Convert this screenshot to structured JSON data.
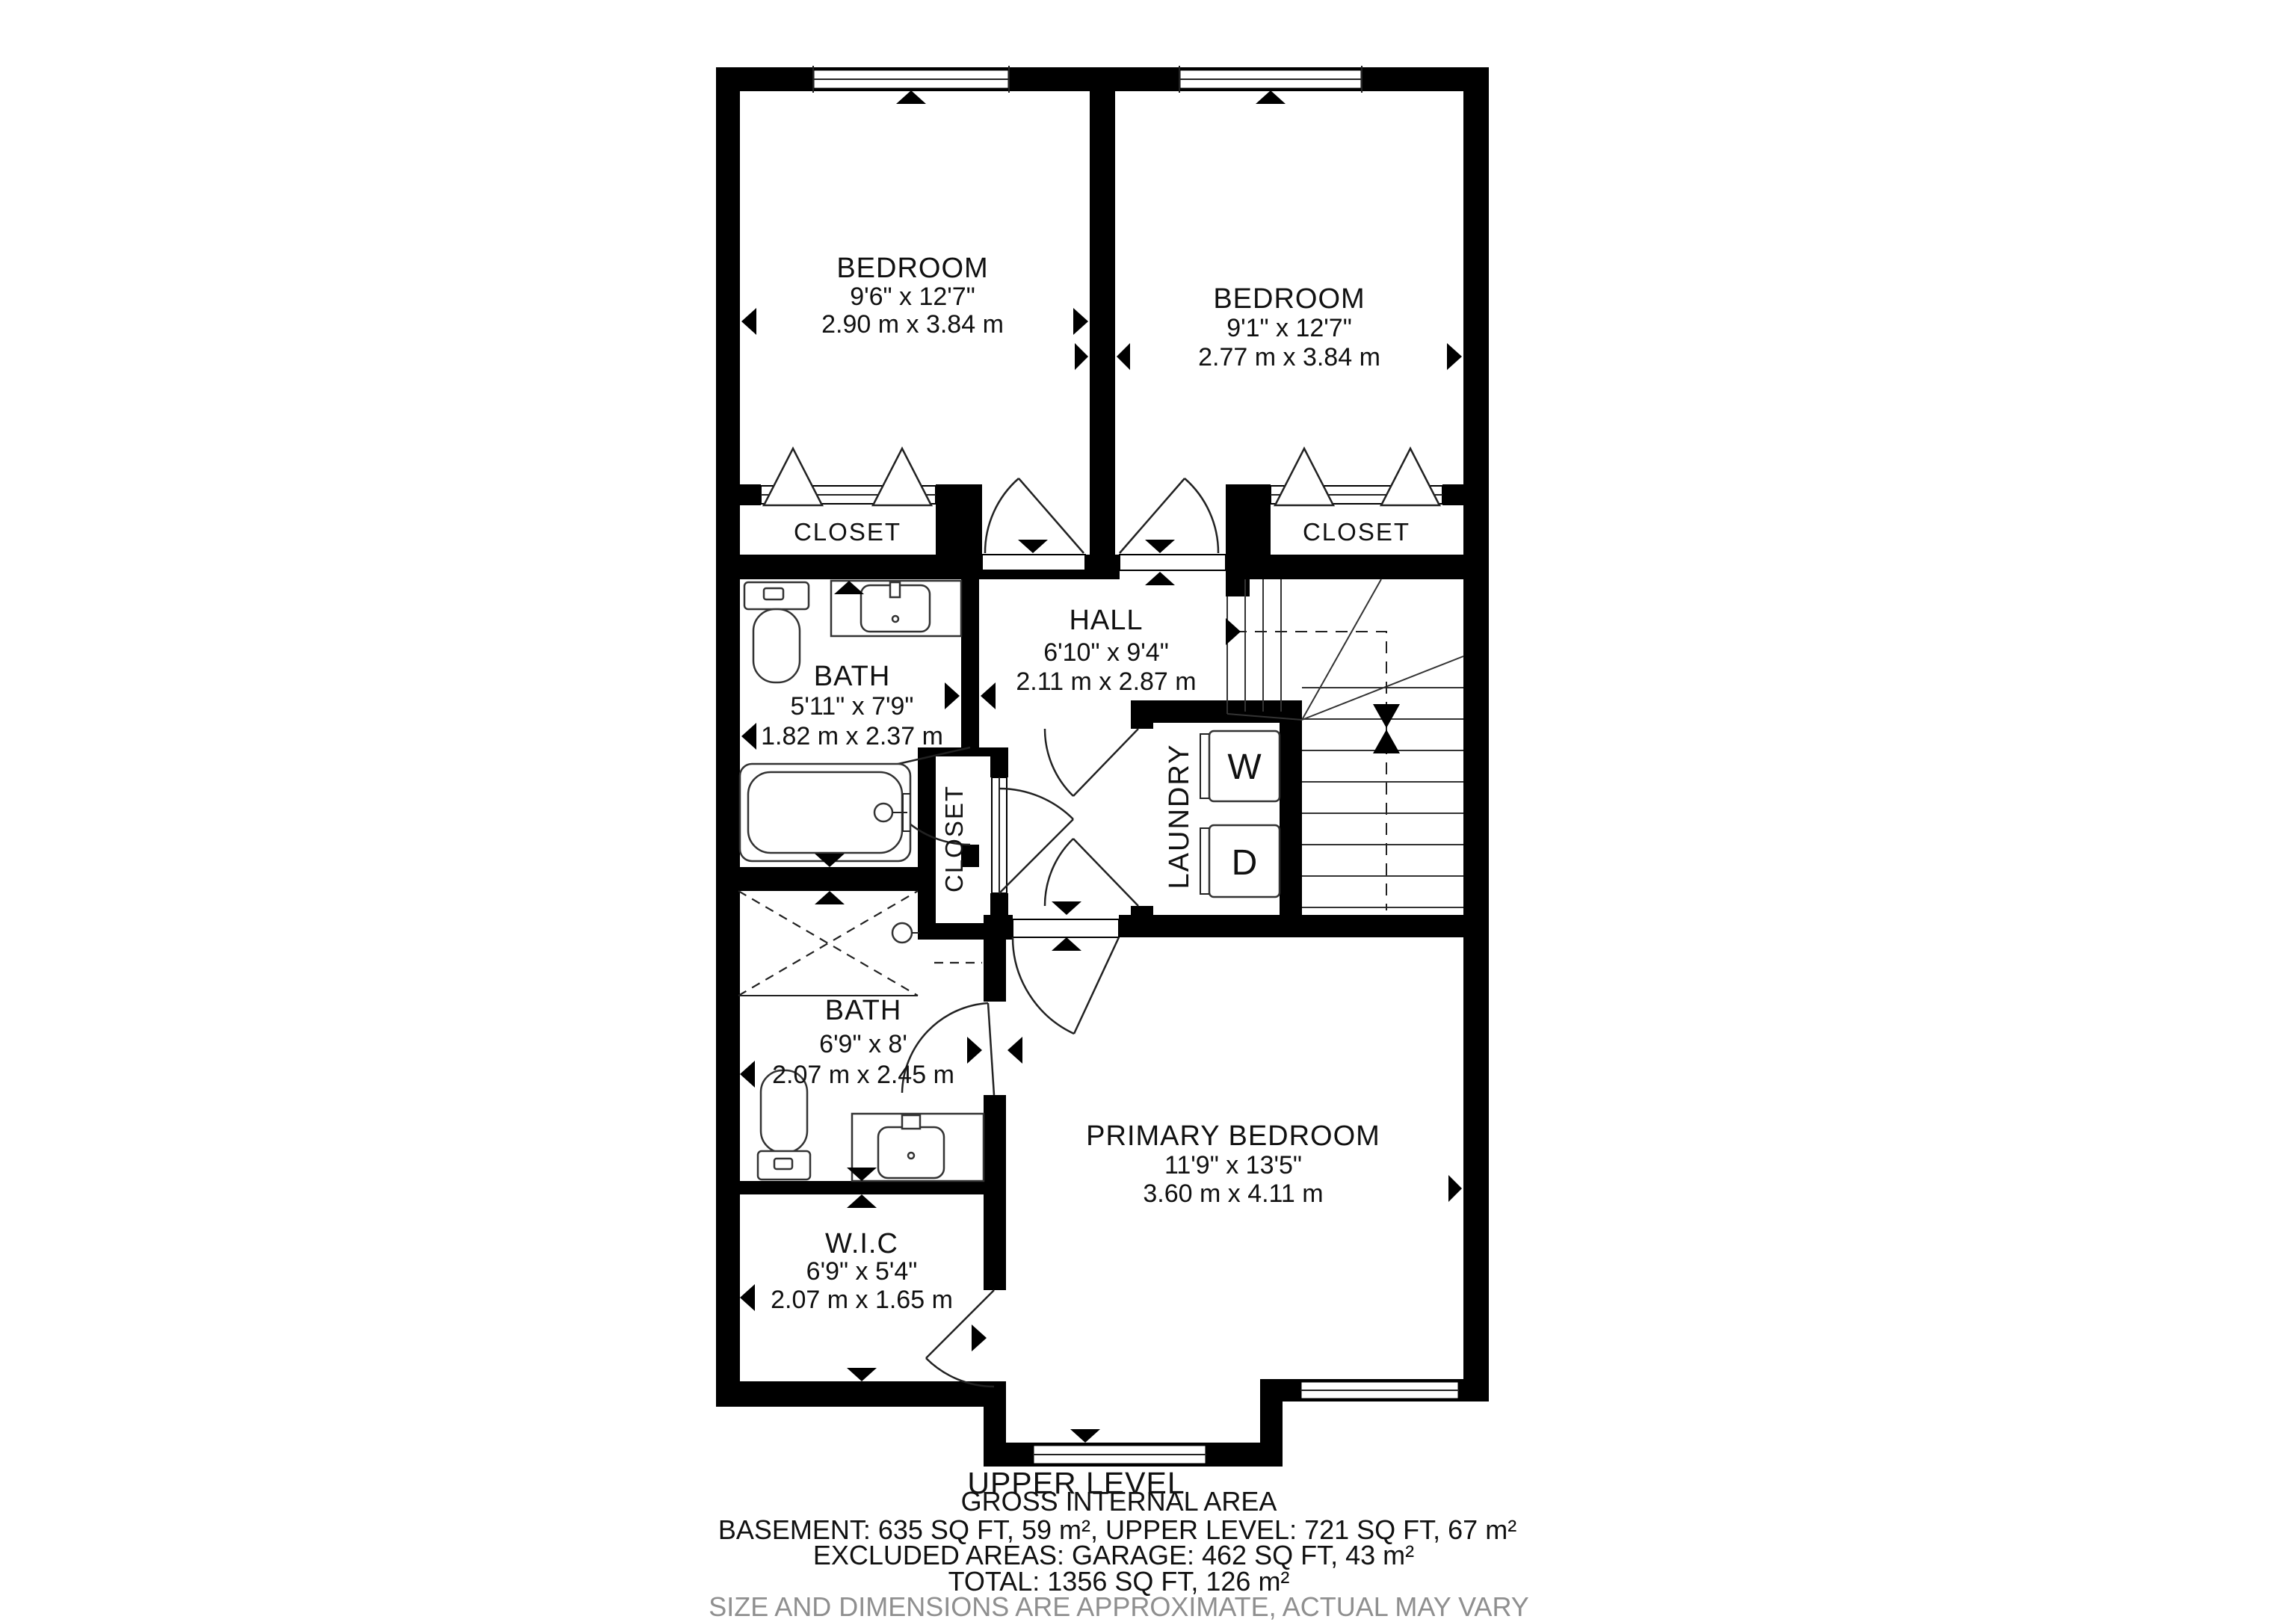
{
  "plan": {
    "level_title": "UPPER LEVEL",
    "rooms": {
      "bedroom_left": {
        "name": "BEDROOM",
        "imperial": "9'6\" x 12'7\"",
        "metric": "2.90 m x 3.84 m"
      },
      "bedroom_right": {
        "name": "BEDROOM",
        "imperial": "9'1\" x 12'7\"",
        "metric": "2.77 m x 3.84 m"
      },
      "closet_left": {
        "name": "CLOSET"
      },
      "closet_right": {
        "name": "CLOSET"
      },
      "hall": {
        "name": "HALL",
        "imperial": "6'10\" x 9'4\"",
        "metric": "2.11 m x 2.87 m"
      },
      "bath_upper": {
        "name": "BATH",
        "imperial": "5'11\" x 7'9\"",
        "metric": "1.82 m x 2.37 m"
      },
      "closet_small": {
        "name": "CLOSET"
      },
      "laundry": {
        "name": "LAUNDRY",
        "washer": "W",
        "dryer": "D"
      },
      "bath_lower": {
        "name": "BATH",
        "imperial": "6'9\" x 8'",
        "metric": "2.07 m x 2.45 m"
      },
      "wic": {
        "name": "W.I.C",
        "imperial": "6'9\" x 5'4\"",
        "metric": "2.07 m x 1.65 m"
      },
      "primary": {
        "name": "PRIMARY BEDROOM",
        "imperial": "11'9\" x 13'5\"",
        "metric": "3.60 m x 4.11 m"
      }
    },
    "footer": {
      "gross": "GROSS INTERNAL AREA",
      "line1": "BASEMENT: 635 SQ FT, 59 m², UPPER LEVEL: 721 SQ FT, 67 m²",
      "line2": "EXCLUDED AREAS: GARAGE: 462 SQ FT, 43 m²",
      "line3": "TOTAL: 1356 SQ FT, 126 m²",
      "disclaimer": "SIZE AND DIMENSIONS ARE APPROXIMATE, ACTUAL MAY VARY"
    },
    "colors": {
      "wall": "#000000",
      "text": "#111111",
      "disclaimer_gray": "#8f8f8f"
    }
  }
}
